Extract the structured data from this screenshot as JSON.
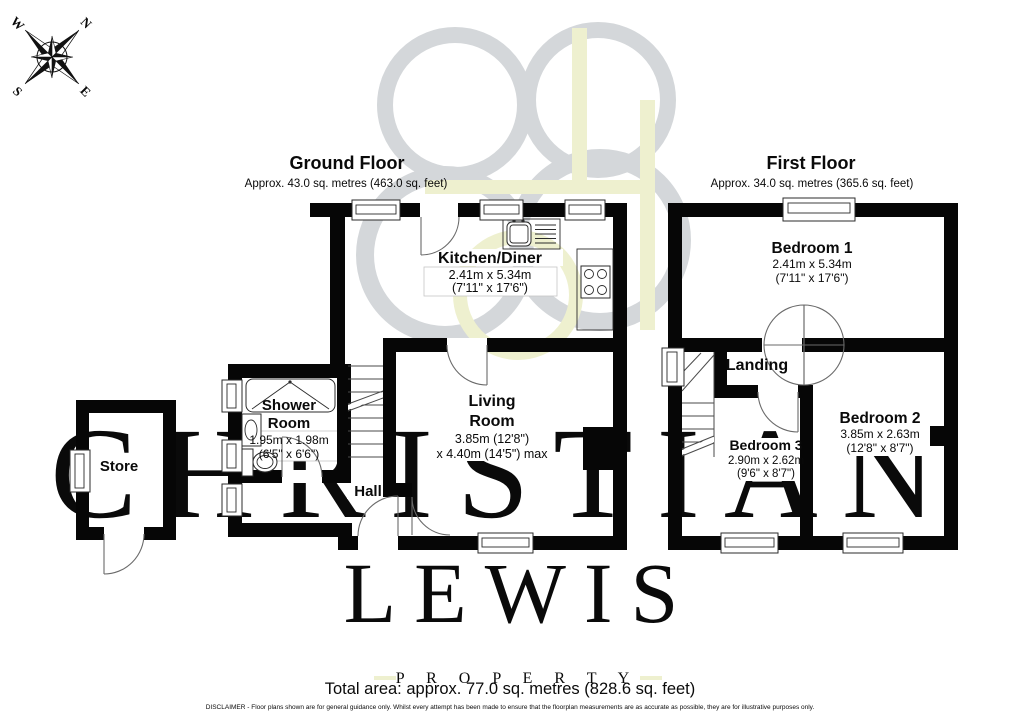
{
  "compass": {
    "n": "N",
    "e": "E",
    "s": "S",
    "w": "W"
  },
  "watermark": {
    "line1": "CHRISTIAN",
    "line2": "LEWIS",
    "line3": "P R O P E R T Y",
    "gray": "#d8d9db",
    "green": "#eef0d0"
  },
  "ground_floor": {
    "title": "Ground Floor",
    "subtitle": "Approx. 43.0 sq. metres (463.0 sq. feet)",
    "rooms": {
      "kitchen": {
        "name": "Kitchen/Diner",
        "dim_m": "2.41m x 5.34m",
        "dim_ft": "(7'11\" x 17'6\")"
      },
      "living": {
        "name1": "Living",
        "name2": "Room",
        "dim_m": "3.85m (12'8\")",
        "dim_ft": "x 4.40m (14'5\") max"
      },
      "shower": {
        "name1": "Shower",
        "name2": "Room",
        "dim_m": "1.95m x 1.98m",
        "dim_ft": "(6'5\" x 6'6\")"
      },
      "hall": {
        "name": "Hall"
      },
      "store": {
        "name": "Store"
      }
    }
  },
  "first_floor": {
    "title": "First Floor",
    "subtitle": "Approx. 34.0 sq. metres (365.6 sq. feet)",
    "rooms": {
      "bedroom1": {
        "name": "Bedroom 1",
        "dim_m": "2.41m x 5.34m",
        "dim_ft": "(7'11\" x 17'6\")"
      },
      "bedroom2": {
        "name": "Bedroom 2",
        "dim_m": "3.85m x 2.63m",
        "dim_ft": "(12'8\" x 8'7\")"
      },
      "bedroom3": {
        "name": "Bedroom 3",
        "dim_m": "2.90m x 2.62m",
        "dim_ft": "(9'6\" x 8'7\")"
      },
      "landing": {
        "name": "Landing"
      }
    }
  },
  "footer": {
    "total_area": "Total area: approx. 77.0 sq. metres (828.6 sq. feet)",
    "disclaimer": "DISCLAIMER -  Floor plans shown are for general guidance only. Whilst every attempt has been made to ensure that the floorplan measurements are as accurate as possible, they are for illustrative purposes only."
  },
  "colors": {
    "wall": "#060606",
    "logo_gray": "#d4d7da",
    "logo_green": "#eef0cf"
  }
}
